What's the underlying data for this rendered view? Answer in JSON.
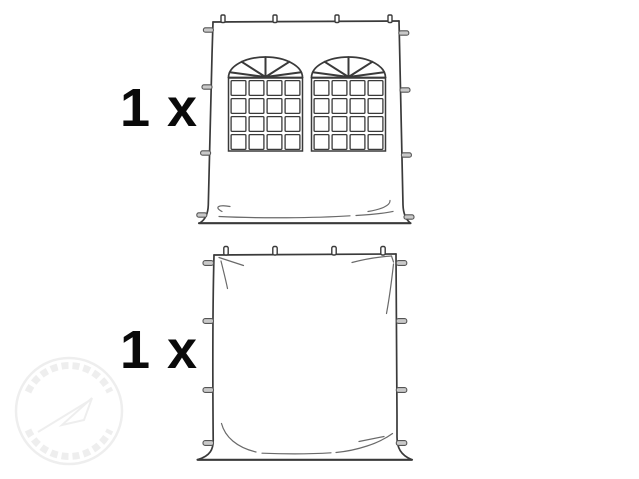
{
  "figure": {
    "type": "package-contents-line-drawing",
    "background": "#ffffff"
  },
  "items": [
    {
      "quantity": "1 x",
      "illustration_icon": "tent-sidewall-with-two-arched-windows-icon"
    },
    {
      "quantity": "1 x",
      "illustration_icon": "tent-sidewall-plain-icon"
    }
  ],
  "watermark": {
    "icon": "circular-logo-watermark-icon"
  },
  "colors": {
    "background": "#ffffff",
    "line": "#3a3a3a",
    "label": "#0a0a0a",
    "tab_fill": "#c9c9c9",
    "watermark": "#ededed"
  }
}
